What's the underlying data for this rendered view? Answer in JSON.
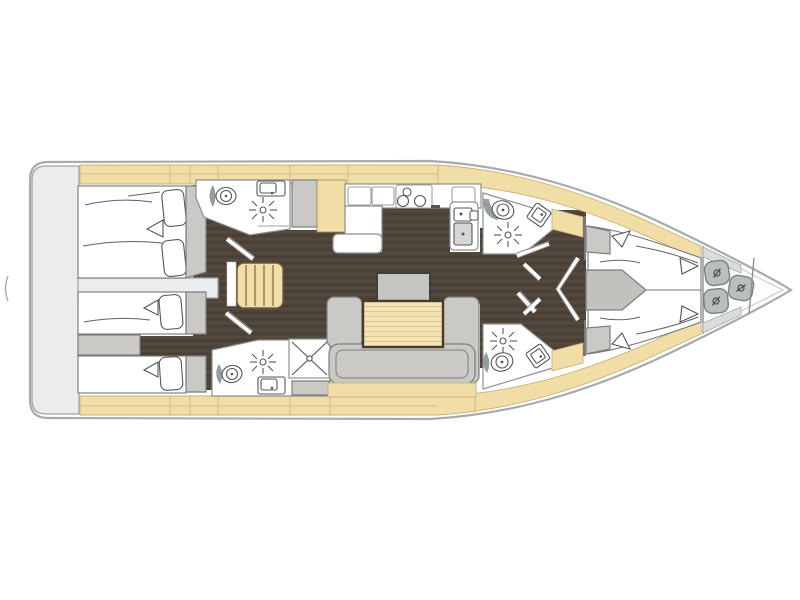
{
  "figure": {
    "type": "sailing-yacht-interior-floor-plan",
    "orientation": "bow-right"
  },
  "colors": {
    "hull_stroke": "#a6abae",
    "hull_inner_stroke": "#c3c7c9",
    "platform_gray": "#eaecee",
    "platform_stroke": "#a0a5a9",
    "wood_floor_dark": "#4e4339",
    "wood_floor_line": "#5c5044",
    "wood_tan": "#f1dda6",
    "wood_tan_line": "#c9b277",
    "table_tan": "#f3e4b6",
    "table_stripe": "#ddc68e",
    "table_border": "#4a382a",
    "furniture_gray": "#cbc9c5",
    "wall_stroke": "#8b8f92",
    "fixture_stroke": "#54575a",
    "fender_fill": "#b7c1bb",
    "fender_stroke": "#78837d"
  },
  "icons": {
    "toilet_icon": "double-circle-with-dot",
    "sink_icon": "rounded-square-with-tap-dot",
    "shower_drain_icon": "radiating-star",
    "stove_burners_icon": "three-circles",
    "companionway_stairs_icon": "striped-planks",
    "door_swing_icon": "diagonal-slash",
    "fender_icon": "rounded-square-with-valve-mark",
    "berth_icon": "mattress-with-pillows"
  },
  "spaces": {
    "swim_platform": 1,
    "aft_double_cabin_port": 1,
    "aft_single_berths_starboard": 2,
    "aft_heads": 2,
    "shower_stall": 1,
    "galley": 1,
    "salon_u_sofa_with_table": 1,
    "forward_heads": 2,
    "forward_v_berth_cabin": 1,
    "bow_locker_fenders": 3
  }
}
